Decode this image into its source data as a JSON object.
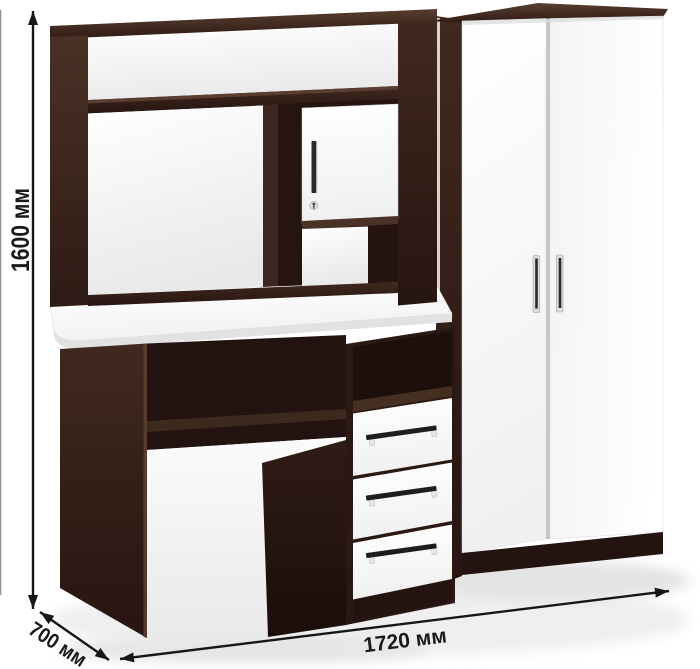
{
  "illustration": {
    "subject": "Computer desk with hutch and two-door wardrobe, wenge dark brown and white facades",
    "colors": {
      "wenge": "#3D2720",
      "wenge_dark": "#241310",
      "wenge_light": "#5A3D30",
      "facade_white": "#FFFFFF",
      "facade_shadow": "#ECECEC",
      "handle_chrome": "#DCDCDC",
      "handle_dark": "#2A2A2A",
      "dimension_ink": "#161616",
      "background": "#FFFFFF"
    },
    "components": [
      {
        "name": "desk-with-hutch",
        "hutch_doors": 1,
        "drawers": 3,
        "open_niches": 4
      },
      {
        "name": "wardrobe",
        "doors": 2,
        "handles": 2
      }
    ]
  },
  "dimensions": {
    "height": {
      "label": "1600 мм",
      "value": 1600,
      "unit": "мм"
    },
    "width": {
      "label": "1720 мм",
      "value": 1720,
      "unit": "мм"
    },
    "depth": {
      "label": "700 мм",
      "value": 700,
      "unit": "мм"
    }
  }
}
